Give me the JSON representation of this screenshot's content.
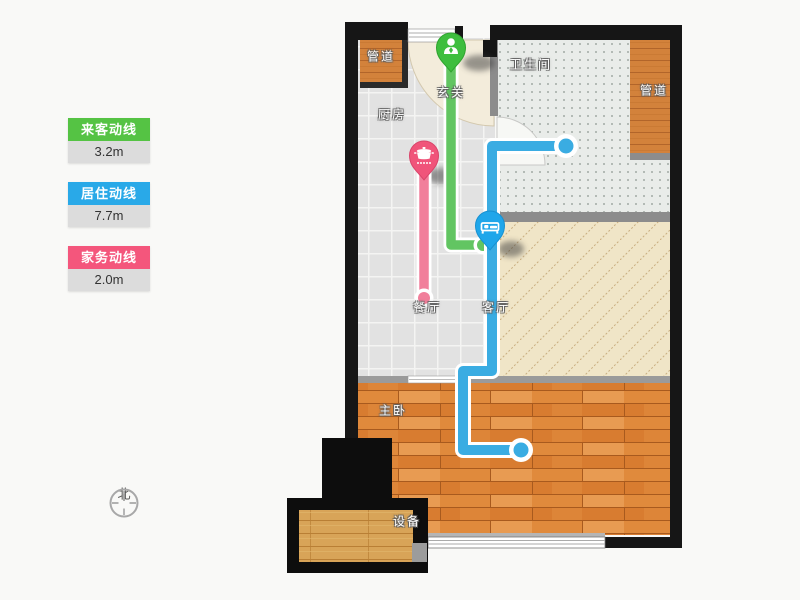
{
  "legend": {
    "items": [
      {
        "label": "来客动线",
        "value": "3.2m",
        "color": "#55c344"
      },
      {
        "label": "居住动线",
        "value": "7.7m",
        "color": "#29a9e8"
      },
      {
        "label": "家务动线",
        "value": "2.0m",
        "color": "#f4567c"
      }
    ]
  },
  "compass": {
    "north_label": "北"
  },
  "floorplan": {
    "rooms": {
      "pipe_left": {
        "label": "管道"
      },
      "entrance": {
        "label": "玄关"
      },
      "kitchen": {
        "label": "厨房"
      },
      "bathroom": {
        "label": "卫生间"
      },
      "pipe_right": {
        "label": "管道"
      },
      "dining": {
        "label": "餐厅"
      },
      "living": {
        "label": "客厅"
      },
      "bedroom": {
        "label": "主卧"
      },
      "equipment": {
        "label": "设备"
      }
    },
    "routes": [
      {
        "name": "visitor-route",
        "label": "来客动线",
        "length": "3.2m",
        "line_color": "#62c562",
        "pin_color": "#3ebe3e",
        "pin_icon": "person-icon"
      },
      {
        "name": "resident-route",
        "label": "居住动线",
        "length": "7.7m",
        "line_color": "#3aace2",
        "pin_color": "#1fa6ea",
        "pin_icon": "bed-icon"
      },
      {
        "name": "housework-route",
        "label": "家务动线",
        "length": "2.0m",
        "line_color": "#f17f9b",
        "pin_color": "#f0547a",
        "pin_icon": "pot-icon"
      }
    ]
  }
}
